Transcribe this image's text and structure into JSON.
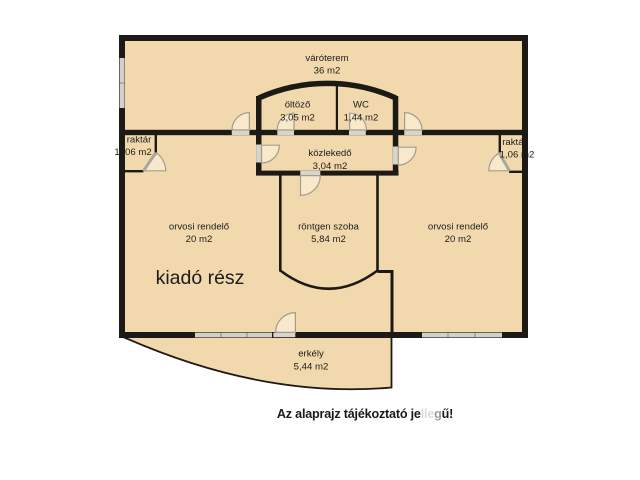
{
  "plan": {
    "rooms": {
      "varoterem": {
        "name": "váróterem",
        "area": "36 m2"
      },
      "oltozo": {
        "name": "öltöző",
        "area": "3,05 m2"
      },
      "wc": {
        "name": "WC",
        "area": "1,44 m2"
      },
      "kozlekedo": {
        "name": "közlekedő",
        "area": "3,04 m2"
      },
      "raktar_left": {
        "name": "raktár",
        "area": "1, 06 m2"
      },
      "raktar_right": {
        "name": "raktár",
        "area": "1,06 m2"
      },
      "orvosi_left": {
        "name": "orvosi rendelő",
        "area": "20 m2"
      },
      "rontgen": {
        "name": "röntgen szoba",
        "area": "5,84 m2"
      },
      "orvosi_right": {
        "name": "orvosi rendelő",
        "area": "20 m2"
      },
      "erkely": {
        "name": "erkély",
        "area": "5,44 m2"
      }
    },
    "kiado_label": "kiadó rész",
    "caption": {
      "segments": [
        {
          "text": "Az alaprajz tájékoztató je",
          "color": "#1a1a1a"
        },
        {
          "text": "lle",
          "color": "#dcdcdc"
        },
        {
          "text": "g",
          "color": "#9c9c9c"
        },
        {
          "text": "ű!",
          "color": "#1a1a1a"
        }
      ]
    },
    "colors": {
      "floor": "#f2d9ad",
      "wall": "#1d1a16",
      "window": "#d3d0c8",
      "doorway": "#d8d4cb",
      "door_fill": "#f8e9cb",
      "door_arc": "#a29c8e",
      "door_leaf": "#aaa69a"
    }
  }
}
